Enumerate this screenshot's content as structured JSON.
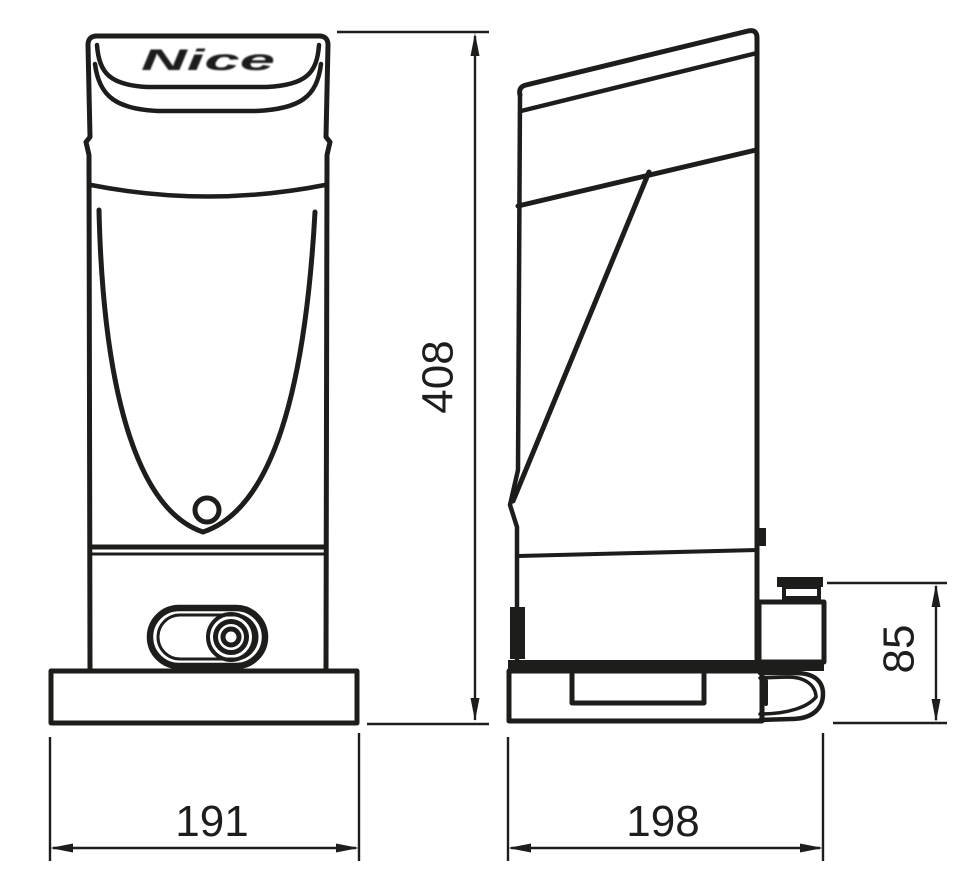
{
  "drawing": {
    "brand": "Nice",
    "colors": {
      "line": "#1d1d1b",
      "background": "#ffffff"
    },
    "dimensions": {
      "overall_height": "408",
      "front_width": "191",
      "side_depth": "198",
      "rear_unit_height": "85"
    }
  }
}
